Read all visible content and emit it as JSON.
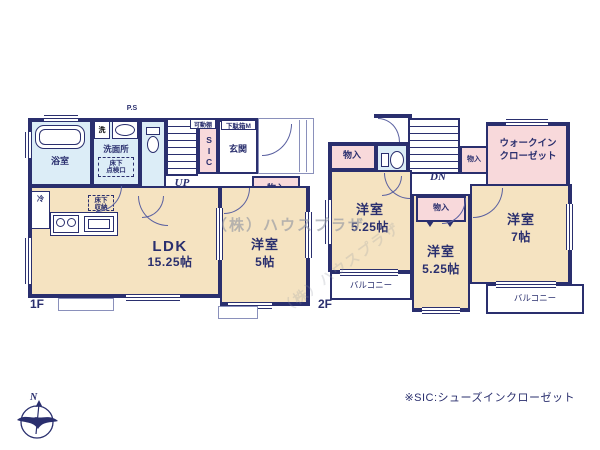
{
  "watermark": "（株）ハウスプラザ",
  "note": "※SIC:シューズインクローゼット",
  "compass": {
    "north": "N"
  },
  "f1": {
    "floor": "1F",
    "ps": "P.S",
    "bath": "浴室",
    "washer": "洗",
    "washroom": "洗面所",
    "hatch1": "床下",
    "hatch2": "点検口",
    "fridge": "冷",
    "shelf": "可動棚",
    "shoebox": "下駄箱M",
    "sic": "SIC",
    "entrance": "玄関",
    "up": "UP",
    "closet": "物入",
    "storage1": "床下",
    "storage2": "収納",
    "ldk": "LDK",
    "ldk_size": "15.25帖",
    "bedroom": "洋室",
    "bedroom_size": "5帖"
  },
  "f2": {
    "floor": "2F",
    "closet_a": "物入",
    "closet_b": "物入",
    "closet_c": "物入",
    "dn": "DN",
    "wic1": "ウォークイン",
    "wic2": "クローゼット",
    "room_l": "洋室",
    "room_l_size": "5.25帖",
    "room_c": "洋室",
    "room_c_size": "5.25帖",
    "room_r": "洋室",
    "room_r_size": "7帖",
    "balcony_l": "バルコニー",
    "balcony_r": "バルコニー"
  },
  "colors": {
    "wall": "#2a2f6e",
    "room": "#f5e3c1",
    "closet": "#f8d9db",
    "wet_area": "#dcedf7"
  }
}
